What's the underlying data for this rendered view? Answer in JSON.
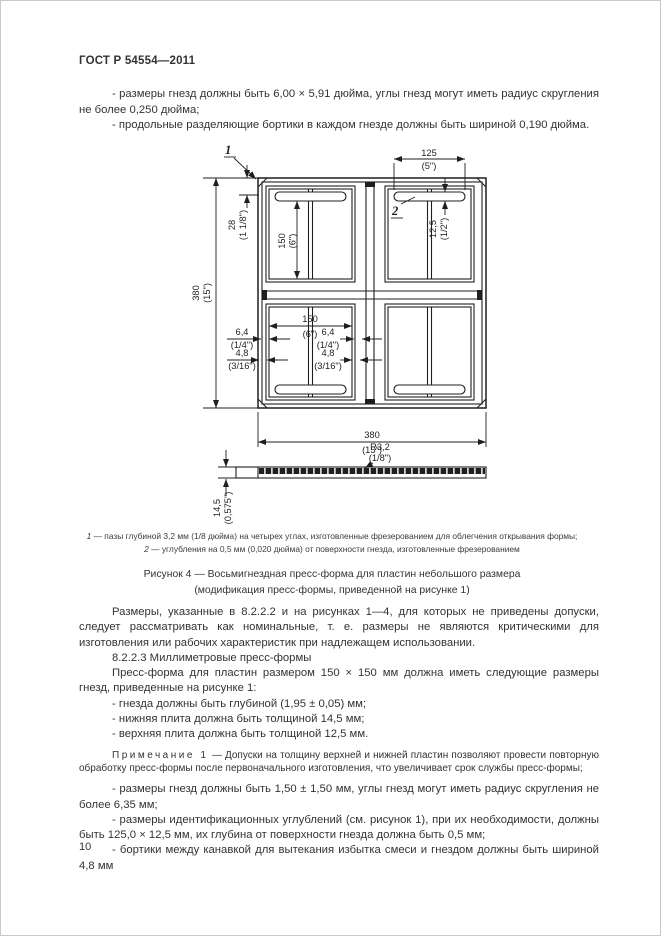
{
  "page": {
    "header": "ГОСТ Р 54554—2011",
    "number": "10"
  },
  "intro": {
    "bullets": [
      "- размеры гнезд должны быть 6,00 × 5,91 дюйма, углы гнезд могут иметь радиус скругления не более 0,250 дюйма;",
      "- продольные разделяющие бортики в каждом гнезде должны быть шириной 0,190 дюйма."
    ]
  },
  "figure": {
    "callouts": {
      "groove": "1",
      "recess": "2"
    },
    "dims": {
      "recess_width": {
        "mm": "125",
        "in": "(5\")"
      },
      "recess_offset": {
        "mm": "12,5",
        "in": "(1/2\")"
      },
      "edge_offset": {
        "mm": "28",
        "in": "(1 1/8\")"
      },
      "cavity_height": {
        "mm": "150",
        "in": "(6\")"
      },
      "overall_height": {
        "mm": "380",
        "in": "(15\")"
      },
      "cavity_width": {
        "mm": "150",
        "in": "(6\")"
      },
      "rim_left": {
        "mm": "6,4",
        "in": "(1/4\")"
      },
      "rim_right": {
        "mm": "6,4",
        "in": "(1/4\")"
      },
      "rib_left": {
        "mm": "4,8",
        "in": "(3/16\")"
      },
      "rib_right": {
        "mm": "4,8",
        "in": "(3/16\")"
      },
      "overall_width": {
        "mm": "380",
        "in": "(15\")"
      },
      "corner_radius": {
        "mm": "R3,2",
        "in": "(1/8\")"
      },
      "plate_thickness": {
        "mm": "14,5",
        "in": "(0,575\")"
      }
    },
    "footnotes": [
      {
        "marker": "1",
        "text": " — пазы глубиной 3,2 мм (1/8 дюйма) на четырех углах, изготовленные фрезерованием для облегчения открывания формы;"
      },
      {
        "marker": "2",
        "text": " — углубления на 0,5 мм (0,020 дюйма) от поверхности гнезда, изготовленные фрезерованием"
      }
    ],
    "caption_line1": "Рисунок 4 — Восьмигнездная пресс-форма для пластин небольшого размера",
    "caption_line2": "(модификация пресс-формы, приведенной на рисунке 1)"
  },
  "body": {
    "para_tolerances": "Размеры, указанные в 8.2.2.2 и на рисунках 1—4, для которых не приведены допуски, следует рассматривать как номинальные, т. е. размеры не являются критическими для изготовления или рабочих характеристик при надлежащем использовании.",
    "heading": "8.2.2.3 Миллиметровые пресс-формы",
    "para_intro": "Пресс-форма для пластин размером 150 × 150 мм должна иметь следующие размеры гнезд, приведенные на рисунке 1:",
    "bullets_metric": [
      "- гнезда должны быть глубиной (1,95 ± 0,05) мм;",
      "- нижняя плита должна быть толщиной 14,5 мм;",
      "- верхняя плита должна быть толщиной 12,5 мм."
    ],
    "note_label": "Примечание 1",
    "note_text": "— Допуски на толщину верхней и нижней пластин позволяют провести повторную обработку пресс-формы после первоначального изготовления, что увеличивает срок службы пресс-формы;",
    "bullets_more": [
      "- размеры гнезд должны быть 1,50 ± 1,50 мм, углы гнезд могут иметь радиус скругления не более 6,35 мм;",
      "- размеры идентификационных углублений (см. рисунок 1), при их необходимости, должны быть 125,0 × 12,5 мм, их глубина от поверхности гнезда должна быть 0,5 мм;",
      "- бортики между канавкой для вытекания избытка смеси и гнездом должны быть шириной 4,8 мм"
    ]
  }
}
